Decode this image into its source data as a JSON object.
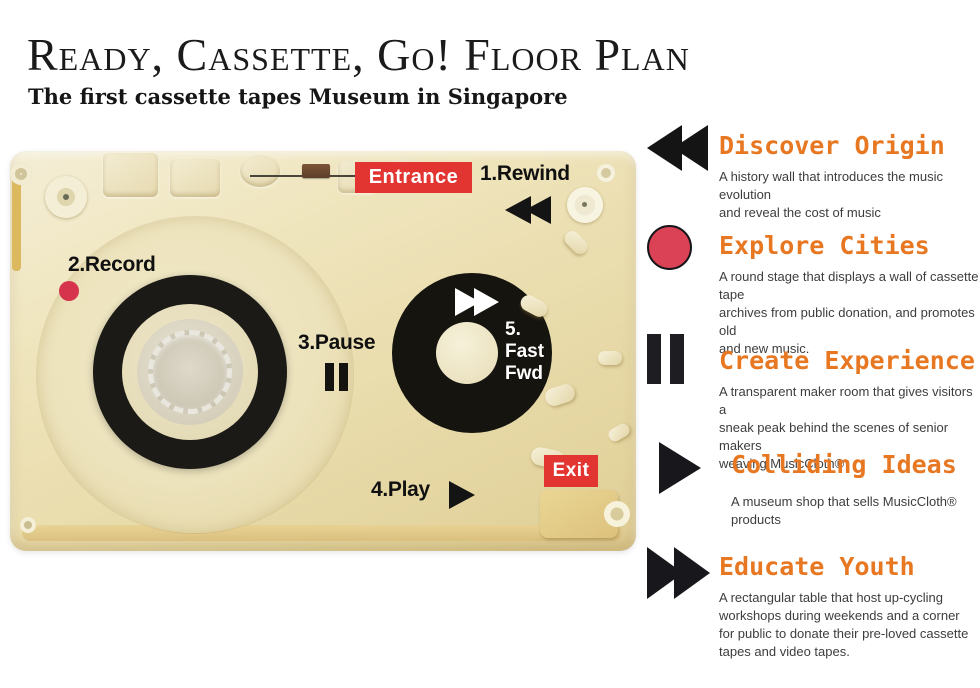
{
  "header": {
    "title": "Ready, Cassette, Go! Floor Plan",
    "subtitle": "The first cassette tapes Museum in Singapore"
  },
  "floorplan": {
    "entrance": "Entrance",
    "exit": "Exit",
    "rewind": "1.Rewind",
    "record": "2.Record",
    "pause": "3.Pause",
    "play": "4.Play",
    "fastfwd": {
      "num": "5.",
      "line1": "Fast",
      "line2": "Fwd"
    }
  },
  "legend": {
    "items": [
      {
        "icon": "rewind-icon",
        "title": "Discover Origin",
        "desc_lines": [
          "A history wall that introduces the music evolution",
          "and reveal the cost of music"
        ]
      },
      {
        "icon": "record-icon",
        "title": "Explore Cities",
        "desc_lines": [
          "A round stage that displays a wall of cassette tape",
          "archives from public donation, and promotes old",
          "and new music."
        ]
      },
      {
        "icon": "pause-icon",
        "title": "Create Experience",
        "desc_lines": [
          "A transparent maker room that gives visitors a",
          "sneak peak behind the scenes of senior makers",
          "weaving MusicCloth®"
        ]
      },
      {
        "icon": "play-icon",
        "title": "Colliding Ideas",
        "desc_lines": [
          "A museum shop that sells MusicCloth® products"
        ]
      },
      {
        "icon": "fast-forward-icon",
        "title": "Educate Youth",
        "desc_lines": [
          "A rectangular table that host up-cycling",
          "workshops during weekends and a corner",
          "for public to donate their pre-loved cassette",
          "tapes and video tapes."
        ]
      }
    ]
  },
  "colors": {
    "heading_orange": "#E87722",
    "label_red": "#E23430",
    "record_red": "#D6344D",
    "legend_circle_red": "#DB4255",
    "icon_black": "#161616",
    "shell_cream": "#EBDFAF",
    "text_dark": "#3D3D3D"
  }
}
